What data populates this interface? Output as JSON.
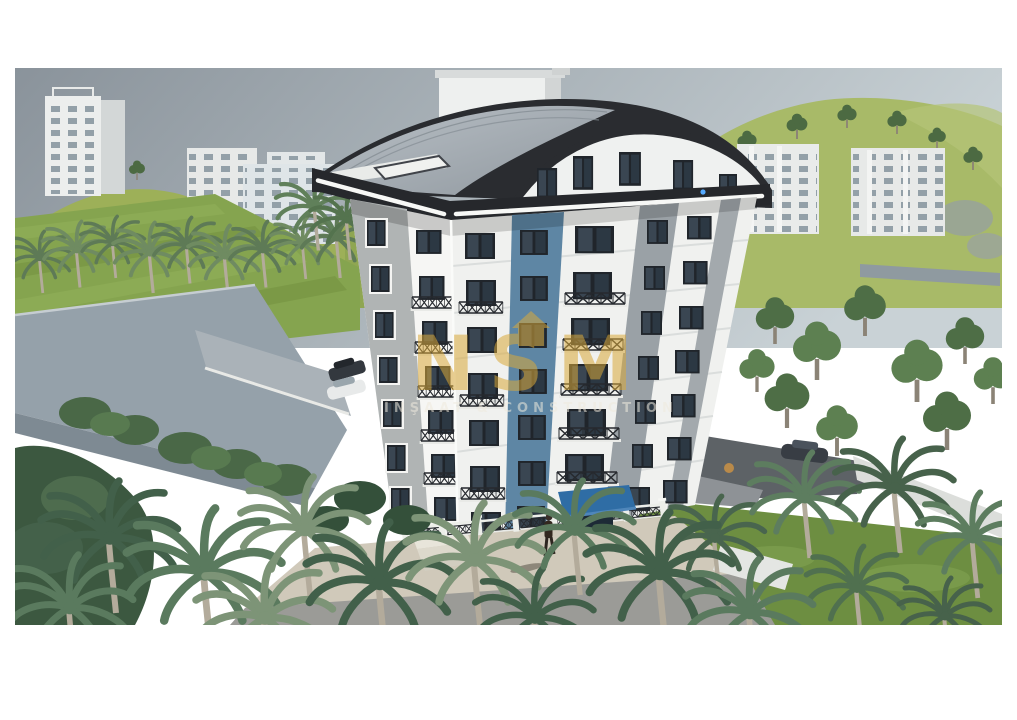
{
  "meta": {
    "title": "Apartment building exterior 3D render"
  },
  "watermark": {
    "brand": "NSM",
    "subtitle": "İNŞAAT & CONSTRUCTION",
    "color": "#D9A93B"
  },
  "palette": {
    "sky_left": "#8A939B",
    "sky_right": "#C9D2D6",
    "hill_green": "#A8BA68",
    "lawn_green": "#6D8E41",
    "facade_white": "#F2F3F1",
    "facade_gray": "#9AA1A6",
    "accent_blue": "#5E86A4",
    "roof_dark": "#26282C",
    "roof_metal": "#9CA3A9",
    "led_strip": "#F7F8F6",
    "canopy_blue": "#2F6DA5",
    "walkway_beige": "#D0C9BA",
    "asphalt_gray": "#5D6266",
    "wall_gray": "#95A1AA"
  },
  "scene": {
    "main_building_floors_visible": 7,
    "background_buildings": 5,
    "vehicles": 3,
    "pedestrians": 1
  }
}
